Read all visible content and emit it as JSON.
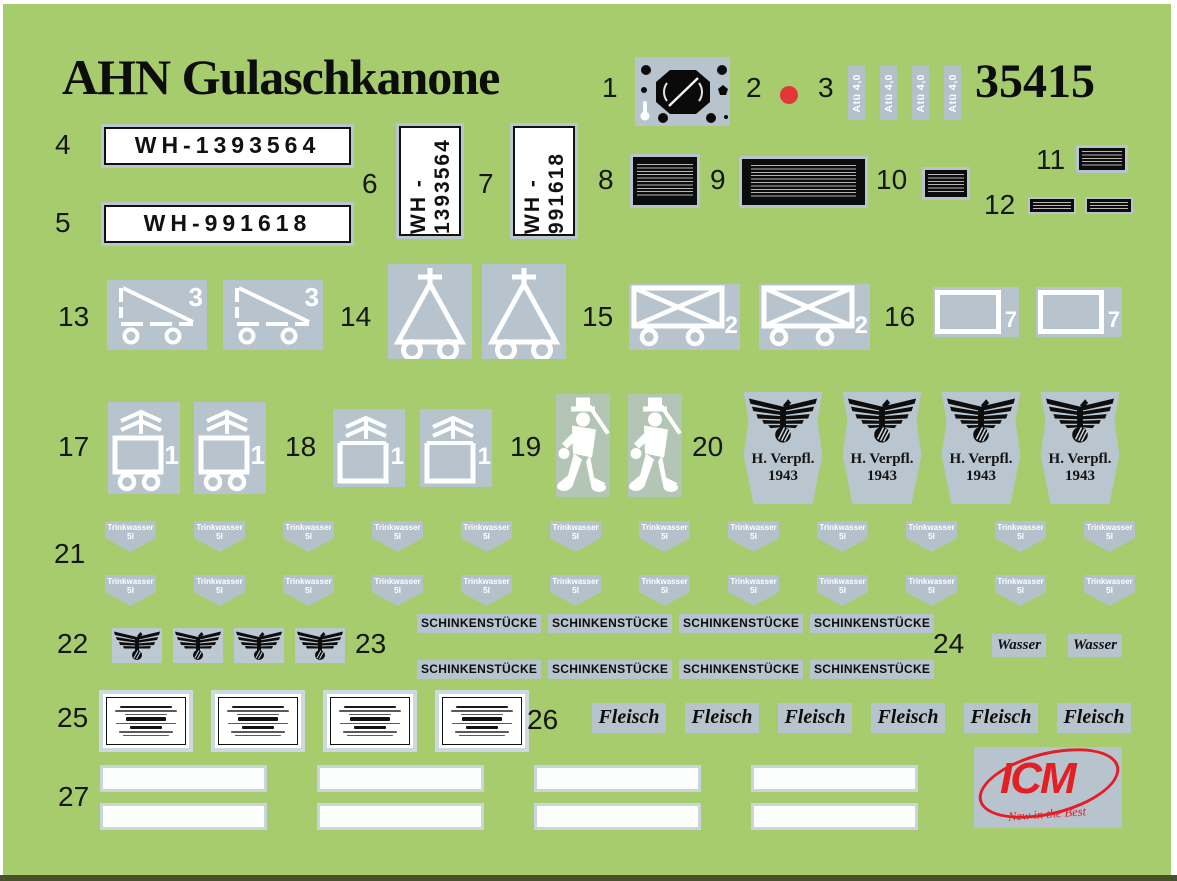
{
  "header": {
    "title": "AHN Gulaschkanone",
    "kit_number": "35415"
  },
  "brand": {
    "name": "ICM",
    "slogan": "New in the Best"
  },
  "colors": {
    "sheet_green": "#a7cc6e",
    "decal_film_grey": "#b7c4ce",
    "red_dot": "#e23737",
    "brand_red": "#e41e25",
    "ink_black": "#0c0c0c",
    "plate_white": "#ffffff"
  },
  "items": {
    "i1": {
      "num": "1"
    },
    "i2": {
      "num": "2"
    },
    "i3": {
      "num": "3",
      "tag_label": "Atü 4,0",
      "tag_count": 4
    },
    "i4": {
      "num": "4",
      "plate": "WH-1393564"
    },
    "i5": {
      "num": "5",
      "plate": "WH-991618"
    },
    "i6": {
      "num": "6",
      "prefix": "WH -",
      "number": "1393564"
    },
    "i7": {
      "num": "7",
      "prefix": "WH -",
      "number": "991618"
    },
    "i8": {
      "num": "8"
    },
    "i9": {
      "num": "9"
    },
    "i10": {
      "num": "10"
    },
    "i11": {
      "num": "11"
    },
    "i12": {
      "num": "12",
      "count": 2
    },
    "i13": {
      "num": "13",
      "digit": "3",
      "count": 2
    },
    "i14": {
      "num": "14",
      "count": 2
    },
    "i15": {
      "num": "15",
      "digit": "2",
      "count": 2
    },
    "i16": {
      "num": "16",
      "digit": "7",
      "count": 2
    },
    "i17": {
      "num": "17",
      "digit": "1",
      "count": 2
    },
    "i18": {
      "num": "18",
      "digit": "1",
      "count": 2
    },
    "i19": {
      "num": "19",
      "count": 2
    },
    "i20": {
      "num": "20",
      "line1": "H. Verpfl.",
      "line2": "1943",
      "count": 4
    },
    "i21": {
      "num": "21",
      "line1": "Trinkwasser",
      "line2": "5l",
      "count": 24
    },
    "i22": {
      "num": "22",
      "count": 4
    },
    "i23": {
      "num": "23",
      "label": "SCHINKENSTÜCKE",
      "count": 8
    },
    "i24": {
      "num": "24",
      "label": "Wasser",
      "count": 2
    },
    "i25": {
      "num": "25",
      "count": 4
    },
    "i26": {
      "num": "26",
      "label": "Fleisch",
      "count": 6
    },
    "i27": {
      "num": "27",
      "count": 8
    }
  }
}
